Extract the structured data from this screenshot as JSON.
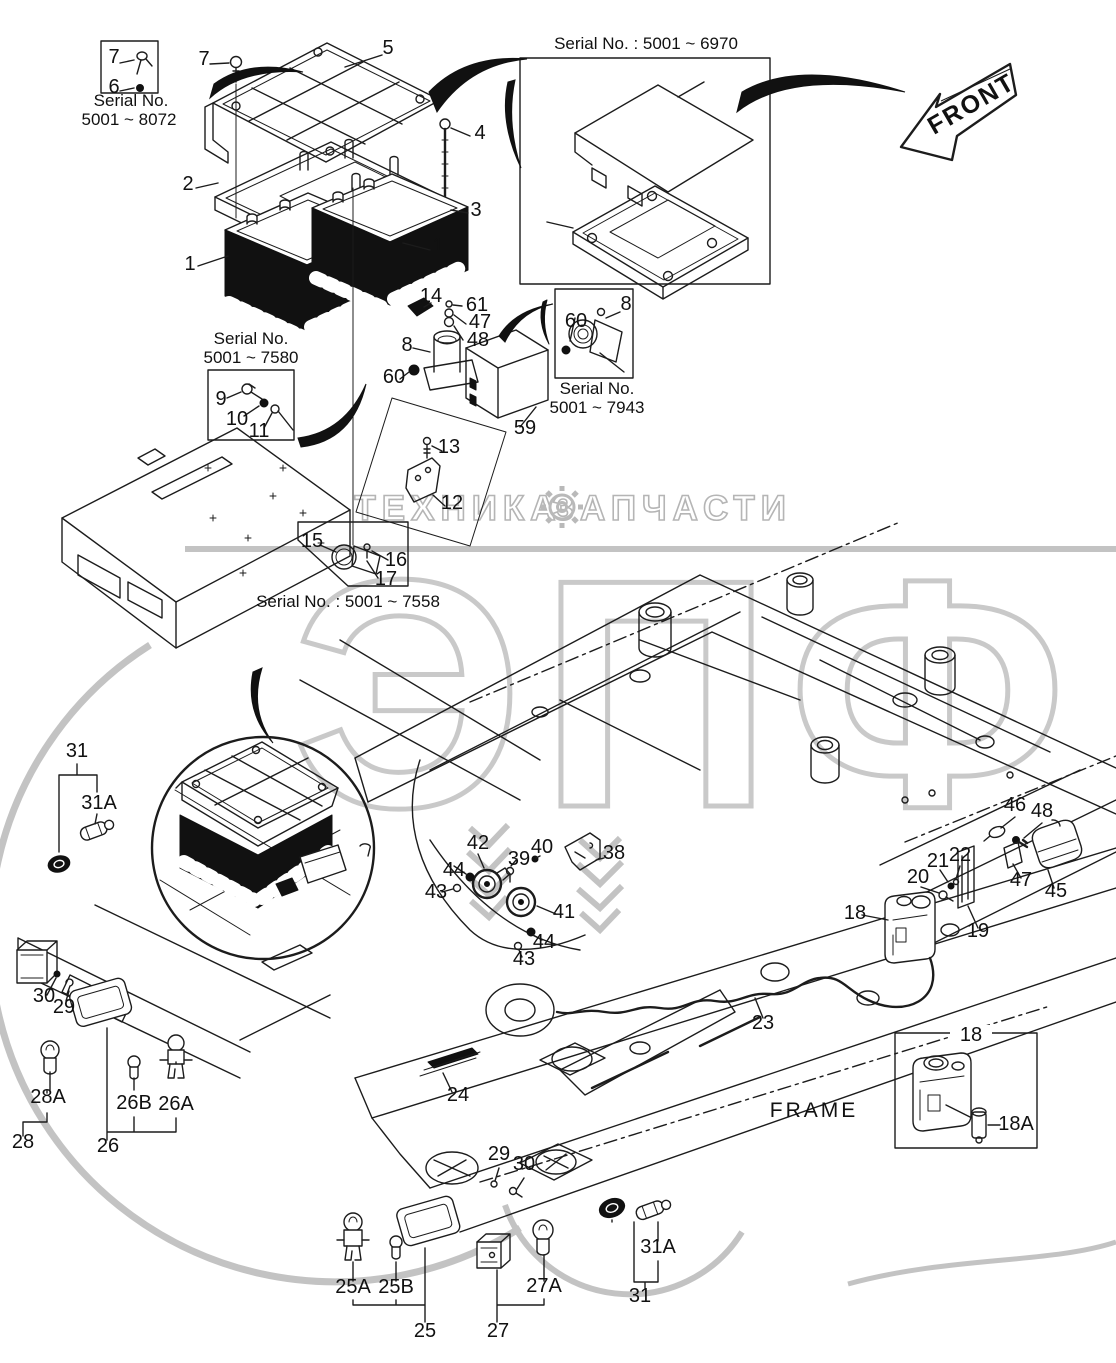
{
  "front_label": "FRONT",
  "frame_label": "FRAME",
  "watermark": {
    "word_left": "ТЕХНИКА",
    "word_right": "ЗАПЧАСТИ",
    "big_text": "ЭПФ",
    "gear_icon": "gear",
    "outline_color": "#b5b5b5",
    "big_color": "#c9c9c9"
  },
  "serial_texts": [
    {
      "text": "Serial No.",
      "x": 131,
      "y": 106
    },
    {
      "text": "5001 ~ 8072",
      "x": 129,
      "y": 125
    },
    {
      "text": "Serial No. : 5001 ~ 6970",
      "x": 646,
      "y": 49
    },
    {
      "text": "Serial No.",
      "x": 251,
      "y": 344
    },
    {
      "text": "5001 ~ 7580",
      "x": 251,
      "y": 363
    },
    {
      "text": "Serial No.",
      "x": 597,
      "y": 394
    },
    {
      "text": "5001 ~ 7943",
      "x": 597,
      "y": 413
    },
    {
      "text": "Serial No. : 5001 ~ 7558",
      "x": 348,
      "y": 607
    }
  ],
  "callouts": [
    {
      "t": "7",
      "x": 114,
      "y": 63
    },
    {
      "t": "6",
      "x": 114,
      "y": 93
    },
    {
      "t": "7",
      "x": 204,
      "y": 65
    },
    {
      "t": "5",
      "x": 388,
      "y": 54
    },
    {
      "t": "4",
      "x": 480,
      "y": 139
    },
    {
      "t": "3",
      "x": 476,
      "y": 216
    },
    {
      "t": "2",
      "x": 188,
      "y": 190
    },
    {
      "t": "1",
      "x": 190,
      "y": 270
    },
    {
      "t": "1",
      "x": 438,
      "y": 252
    },
    {
      "t": "14",
      "x": 431,
      "y": 302
    },
    {
      "t": "61",
      "x": 477,
      "y": 311
    },
    {
      "t": "47",
      "x": 480,
      "y": 328
    },
    {
      "t": "48",
      "x": 478,
      "y": 346
    },
    {
      "t": "8",
      "x": 407,
      "y": 351
    },
    {
      "t": "60",
      "x": 394,
      "y": 383
    },
    {
      "t": "59",
      "x": 525,
      "y": 434
    },
    {
      "t": "60",
      "x": 576,
      "y": 327
    },
    {
      "t": "8",
      "x": 626,
      "y": 310
    },
    {
      "t": "9",
      "x": 221,
      "y": 405
    },
    {
      "t": "10",
      "x": 237,
      "y": 425
    },
    {
      "t": "11",
      "x": 259,
      "y": 437
    },
    {
      "t": "13",
      "x": 449,
      "y": 453
    },
    {
      "t": "12",
      "x": 452,
      "y": 509
    },
    {
      "t": "15",
      "x": 312,
      "y": 547
    },
    {
      "t": "16",
      "x": 396,
      "y": 566
    },
    {
      "t": "17",
      "x": 386,
      "y": 585
    },
    {
      "t": "31",
      "x": 77,
      "y": 757
    },
    {
      "t": "31A",
      "x": 99,
      "y": 809
    },
    {
      "t": "30",
      "x": 44,
      "y": 1002
    },
    {
      "t": "29",
      "x": 64,
      "y": 1013
    },
    {
      "t": "28A",
      "x": 48,
      "y": 1103
    },
    {
      "t": "28",
      "x": 23,
      "y": 1148
    },
    {
      "t": "26B",
      "x": 134,
      "y": 1109
    },
    {
      "t": "26A",
      "x": 176,
      "y": 1110
    },
    {
      "t": "26",
      "x": 108,
      "y": 1152
    },
    {
      "t": "42",
      "x": 478,
      "y": 849
    },
    {
      "t": "44",
      "x": 454,
      "y": 876
    },
    {
      "t": "43",
      "x": 436,
      "y": 898
    },
    {
      "t": "39",
      "x": 519,
      "y": 865
    },
    {
      "t": "40",
      "x": 542,
      "y": 853
    },
    {
      "t": "38",
      "x": 614,
      "y": 859
    },
    {
      "t": "41",
      "x": 564,
      "y": 918
    },
    {
      "t": "44",
      "x": 544,
      "y": 948
    },
    {
      "t": "43",
      "x": 524,
      "y": 965
    },
    {
      "t": "46",
      "x": 1015,
      "y": 811
    },
    {
      "t": "48",
      "x": 1042,
      "y": 817
    },
    {
      "t": "21",
      "x": 938,
      "y": 867
    },
    {
      "t": "22",
      "x": 960,
      "y": 861
    },
    {
      "t": "20",
      "x": 918,
      "y": 883
    },
    {
      "t": "47",
      "x": 1021,
      "y": 886
    },
    {
      "t": "45",
      "x": 1056,
      "y": 897
    },
    {
      "t": "19",
      "x": 978,
      "y": 937
    },
    {
      "t": "18",
      "x": 855,
      "y": 919
    },
    {
      "t": "23",
      "x": 763,
      "y": 1029
    },
    {
      "t": "24",
      "x": 458,
      "y": 1101
    },
    {
      "t": "29",
      "x": 499,
      "y": 1160
    },
    {
      "t": "30",
      "x": 524,
      "y": 1170
    },
    {
      "t": "18",
      "x": 971,
      "y": 1041
    },
    {
      "t": "18A",
      "x": 1016,
      "y": 1130
    },
    {
      "t": "25A",
      "x": 353,
      "y": 1293
    },
    {
      "t": "25B",
      "x": 396,
      "y": 1293
    },
    {
      "t": "25",
      "x": 425,
      "y": 1337
    },
    {
      "t": "27A",
      "x": 544,
      "y": 1292
    },
    {
      "t": "27",
      "x": 498,
      "y": 1337
    },
    {
      "t": "31A",
      "x": 658,
      "y": 1253
    },
    {
      "t": "31",
      "x": 640,
      "y": 1302
    }
  ]
}
